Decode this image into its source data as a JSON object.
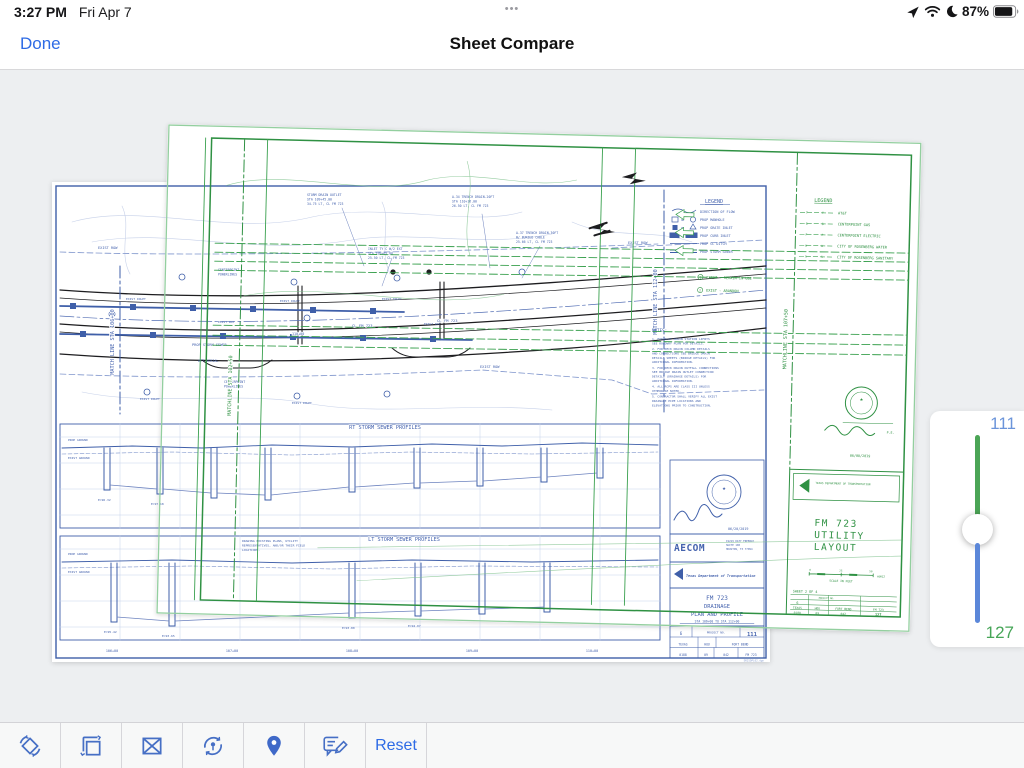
{
  "status_bar": {
    "time": "3:27 PM",
    "date": "Fri Apr 7",
    "handle": "•••",
    "battery_percent": "87%"
  },
  "nav": {
    "done": "Done",
    "title": "Sheet Compare"
  },
  "toolbar": {
    "reset": "Reset"
  },
  "slider": {
    "top_sheet_number": "111",
    "bottom_sheet_number": "127"
  },
  "blue_sheet": {
    "matchline_left": "MATCH LINE STA 106+00",
    "matchline_right": "MATCH LINE STA 112+00",
    "rt_profile_title": "RT STORM SEWER PROFILES",
    "lt_profile_title": "LT STORM SEWER PROFILES",
    "prop_ground": "PROP GROUND",
    "exist_ground": "EXIST GROUND",
    "exist_row": "EXIST ROW",
    "exist_inlet": "EXIST INLET",
    "exist_rcp": "EXIST RCP",
    "prop_storm_sewer": "PROP STORM SEWER",
    "att_aerial": "ATT AERIAL",
    "centerpoint1": "CENTERPOINT",
    "centerpoint2": "POWERLINES",
    "cl_fm723": "CL FM 723",
    "station": "110+00",
    "legend": {
      "title": "LEGEND",
      "or": "OR",
      "items": [
        "DIRECTION OF FLOW",
        "PROP MANHOLE",
        "PROP GRATE INLET",
        "PROP CURB INLET",
        "PROP CL DITCH",
        "PROP STORM SEWER"
      ]
    },
    "callout1": [
      "STORM DRAIN OUTLET",
      "STA 109+45.00",
      "34.75 LT, CL FM 723"
    ],
    "callout2": [
      "A-34 TRENCH DRAIN-20FT",
      "STA 110+16.00",
      "26.50 LT, CL FM 723"
    ],
    "callout3": [
      "A-37 TRENCH DRAIN-30FT",
      "W/ BURIED CABLE",
      "25.66 LT, CL FM 723"
    ],
    "callout4": [
      "INLET TY C W/2 EXT",
      "STA 109+65.00",
      "25.50 LT, CL FM 723"
    ],
    "notes_title": "NOTES:",
    "notes": [
      "1. FOR SLOT DRAIN STATION LIMITS",
      "   SEE ROADWAY PLAN FOR DETAILS.",
      "2. FOR DECK DRAIN COLUMN DETAILS",
      "   AND CONNECTIONS SEE BRIDGE DRAIN",
      "   DETAILS SHEETS (BRIDGE DETAILS) FOR",
      "   ADDITIONAL INFORMATION.",
      "3. FOR DECK DRAIN OUTFALL CONNECTIONS",
      "   SEE BRIDGE DRAIN OUTLET CONNECTION",
      "   DETAILS (DRAINAGE DETAILS) FOR",
      "   ADDITIONAL INFORMATION.",
      "4. ALL RCPS ARE CLASS III UNLESS",
      "   OTHERWISE NOTED.",
      "5. CONTRACTOR SHALL VERIFY ALL EXIST",
      "   DRAINAGE PIPE LOCATIONS AND",
      "   ELEVATIONS PRIOR TO CONSTRUCTION."
    ],
    "general_notes": [
      "DRAWING EXISTING PLANS, UTILITY",
      "REPRESENTATIVES, AND/OR THEIR FIELD",
      "LOCATIONS."
    ],
    "stations": [
      "106+00",
      "107+00",
      "108+00",
      "109+00",
      "110+00"
    ],
    "elevations": [
      "E=95.42",
      "E=93.65",
      "E=93.80",
      "E=94.07",
      "E=96.32",
      "E=97.18"
    ],
    "title_block": {
      "aecom": "AECOM",
      "addr1": "19219 KATY FREEWAY",
      "addr2": "SUITE 100",
      "addr3": "HOUSTON, TX 77094",
      "txdot": "Texas Department of Transportation",
      "t1": "FM 723",
      "t2": "DRAINAGE",
      "t3": "PLAN AND PROFILE",
      "sta": "STA 106+00 TO STA 112+00",
      "project_no": "PROJECT NO.",
      "fed": "6",
      "sheet_no": "111",
      "state": "TEXAS",
      "dist": "HOU",
      "county": "FORT BEND",
      "cont": "0188",
      "sect": "09",
      "job": "042",
      "hwy": "FM 723",
      "file": "DR25DPL02.dgn",
      "seal_date": "06/20/2019"
    }
  },
  "green_sheet": {
    "matchline_left": "MATCHLINE STA 102+50",
    "matchline_right": "MATCHLINE STA 107+50",
    "legend": {
      "title": "LEGEND",
      "items": [
        {
          "sym": "T",
          "label": "AT&T"
        },
        {
          "sym": "G",
          "label": "CENTERPOINT GAS"
        },
        {
          "sym": "P",
          "label": "CENTERPOINT ELECTRIC"
        },
        {
          "sym": "W",
          "label": "CITY OF ROSENBERG WATER"
        },
        {
          "sym": "S",
          "label": "CITY OF ROSENBERG SANITARY"
        }
      ]
    },
    "note1": "EXIST - REMAIN IN USE",
    "note2": "EXIST - ABANDON",
    "pe": "P.E.",
    "seal_date": "06/08/2019",
    "title_block": {
      "txdot": "TEXAS DEPARTMENT OF TRANSPORTATION",
      "t1": "FM 723",
      "t2": "UTILITY",
      "t3": "LAYOUT",
      "scale": "SCALE IN FEET",
      "horiz": "HORIZ",
      "s0": "0",
      "s25": "25",
      "s50": "50",
      "sheet_label": "SHEET 2 OF 4",
      "project_no": "PROJECT NO.",
      "fed": "6",
      "state": "TEXAS",
      "dist": "HOU",
      "county": "FORT BEND",
      "hwy": "FM 723",
      "cont": "0188",
      "sect": "09",
      "job": "042",
      "sheet_no": "127"
    }
  }
}
